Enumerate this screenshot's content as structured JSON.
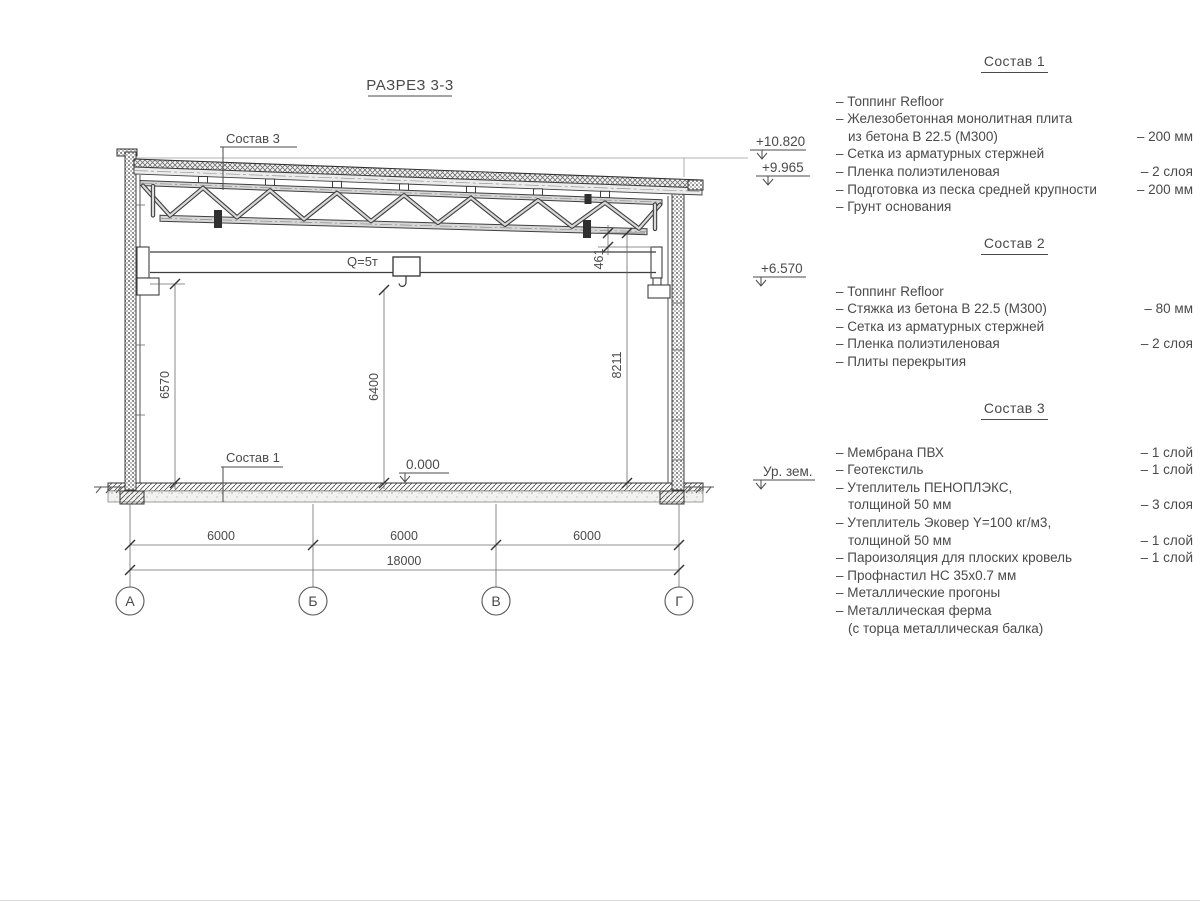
{
  "page": {
    "bg": "#ffffff",
    "line": "#3f3f3f",
    "text": "#4a4a4a"
  },
  "drawing": {
    "title": "РАЗРЕЗ 3-3",
    "callout_top": "Состав 3",
    "callout_floor": "Состав 1",
    "crane_label": "Q=5т",
    "zero_level": "0.000",
    "elevations": {
      "roof_high": "+10.820",
      "roof_low": "+9.965",
      "crane_rail": "+6.570",
      "ground": "Ур. зем."
    },
    "dims": {
      "rail_height": "6570",
      "hook_height": "6400",
      "truss_clear": "8211",
      "gap": "461",
      "span_1": "6000",
      "span_2": "6000",
      "span_3": "6000",
      "total": "18000"
    },
    "axes": {
      "a1": "А",
      "a2": "Б",
      "a3": "В",
      "a4": "Г"
    }
  },
  "legend": {
    "sections": [
      {
        "title": "Состав 1",
        "items": [
          {
            "text": "– Топпинг Refloor",
            "value": ""
          },
          {
            "text": "– Железобетонная  монолитная плита",
            "value": ""
          },
          {
            "text": "из бетона В 22.5 (М300)",
            "value": "– 200 мм"
          },
          {
            "text": "– Сетка из арматурных стержней",
            "value": ""
          },
          {
            "text": "– Пленка полиэтиленовая",
            "value": "– 2 слоя"
          },
          {
            "text": "– Подготовка из песка средней крупности",
            "value": "– 200 мм"
          },
          {
            "text": "– Грунт основания",
            "value": ""
          }
        ]
      },
      {
        "title": "Состав 2",
        "items": [
          {
            "text": "– Топпинг Refloor",
            "value": ""
          },
          {
            "text": "– Стяжка из бетона В 22.5 (М300)",
            "value": "– 80 мм"
          },
          {
            "text": "– Сетка из арматурных стержней",
            "value": ""
          },
          {
            "text": "– Пленка полиэтиленовая",
            "value": "– 2 слоя"
          },
          {
            "text": "– Плиты перекрытия",
            "value": ""
          }
        ]
      },
      {
        "title": "Состав 3",
        "items": [
          {
            "text": "– Мембрана ПВХ",
            "value": "– 1 слой"
          },
          {
            "text": "– Геотекстиль",
            "value": "– 1 слой"
          },
          {
            "text": "– Утеплитель ПЕНОПЛЭКС,",
            "value": ""
          },
          {
            "text": "толщиной 50 мм",
            "value": "– 3 слоя"
          },
          {
            "text": "– Утеплитель Эковер Y=100 кг/м3,",
            "value": ""
          },
          {
            "text": "толщиной 50 мм",
            "value": "– 1 слой"
          },
          {
            "text": "– Пароизоляция для плоских кровель",
            "value": "– 1 слой"
          },
          {
            "text": "– Профнастил НС 35х0.7 мм",
            "value": ""
          },
          {
            "text": "– Металлические прогоны",
            "value": ""
          },
          {
            "text": "– Металлическая ферма",
            "value": ""
          },
          {
            "text": "(с торца металлическая балка)",
            "value": ""
          }
        ]
      }
    ]
  }
}
